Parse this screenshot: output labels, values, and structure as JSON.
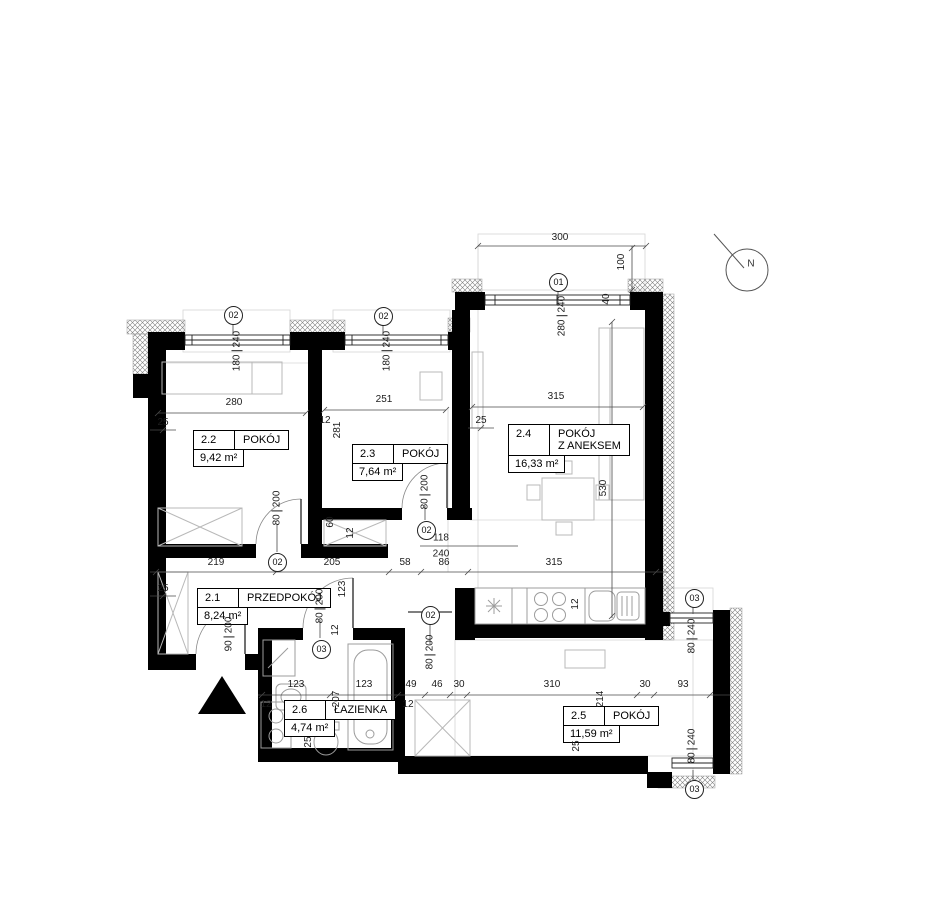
{
  "plan": {
    "rooms": [
      {
        "id": "2.2",
        "name": "POKÓJ",
        "area": "9,42 m²"
      },
      {
        "id": "2.3",
        "name": "POKÓJ",
        "area": "7,64 m²"
      },
      {
        "id": "2.4",
        "name": "POKÓJ",
        "name2": "Z ANEKSEM",
        "area": "16,33 m²"
      },
      {
        "id": "2.1",
        "name": "PRZEDPOKÓJ",
        "area": "8,24 m²"
      },
      {
        "id": "2.6",
        "name": "ŁAZIENKA",
        "area": "4,74 m²"
      },
      {
        "id": "2.5",
        "name": "POKÓJ",
        "area": "11,59 m²"
      }
    ],
    "markers": {
      "win1": "01",
      "win2": "02",
      "win3": "03",
      "door2": "02",
      "door3": "03"
    },
    "openings": {
      "win01": {
        "w": "280",
        "h": "240"
      },
      "win02": {
        "w": "180",
        "h": "240"
      },
      "win03": {
        "w": "80",
        "h": "240"
      },
      "door80": {
        "w": "80",
        "h": "200"
      },
      "door90": {
        "w": "90",
        "h": "200"
      },
      "pass118": {
        "w": "118",
        "h": "240"
      }
    },
    "dims": {
      "top_width": "300",
      "top_offset": "100",
      "seg40": "40",
      "r22_width": "280",
      "r23_width": "251",
      "r24_width": "315",
      "r24_depth": "530",
      "r23_height": "281",
      "t25": "25",
      "t12": "12",
      "t60": "60",
      "t123": "123",
      "t207": "207",
      "t214": "214",
      "chain_mid": [
        "219",
        "205",
        "58",
        "86",
        "315"
      ],
      "chain_low": [
        "123",
        "123",
        "49",
        "46",
        "30",
        "310",
        "30",
        "93"
      ]
    },
    "north": "N"
  }
}
